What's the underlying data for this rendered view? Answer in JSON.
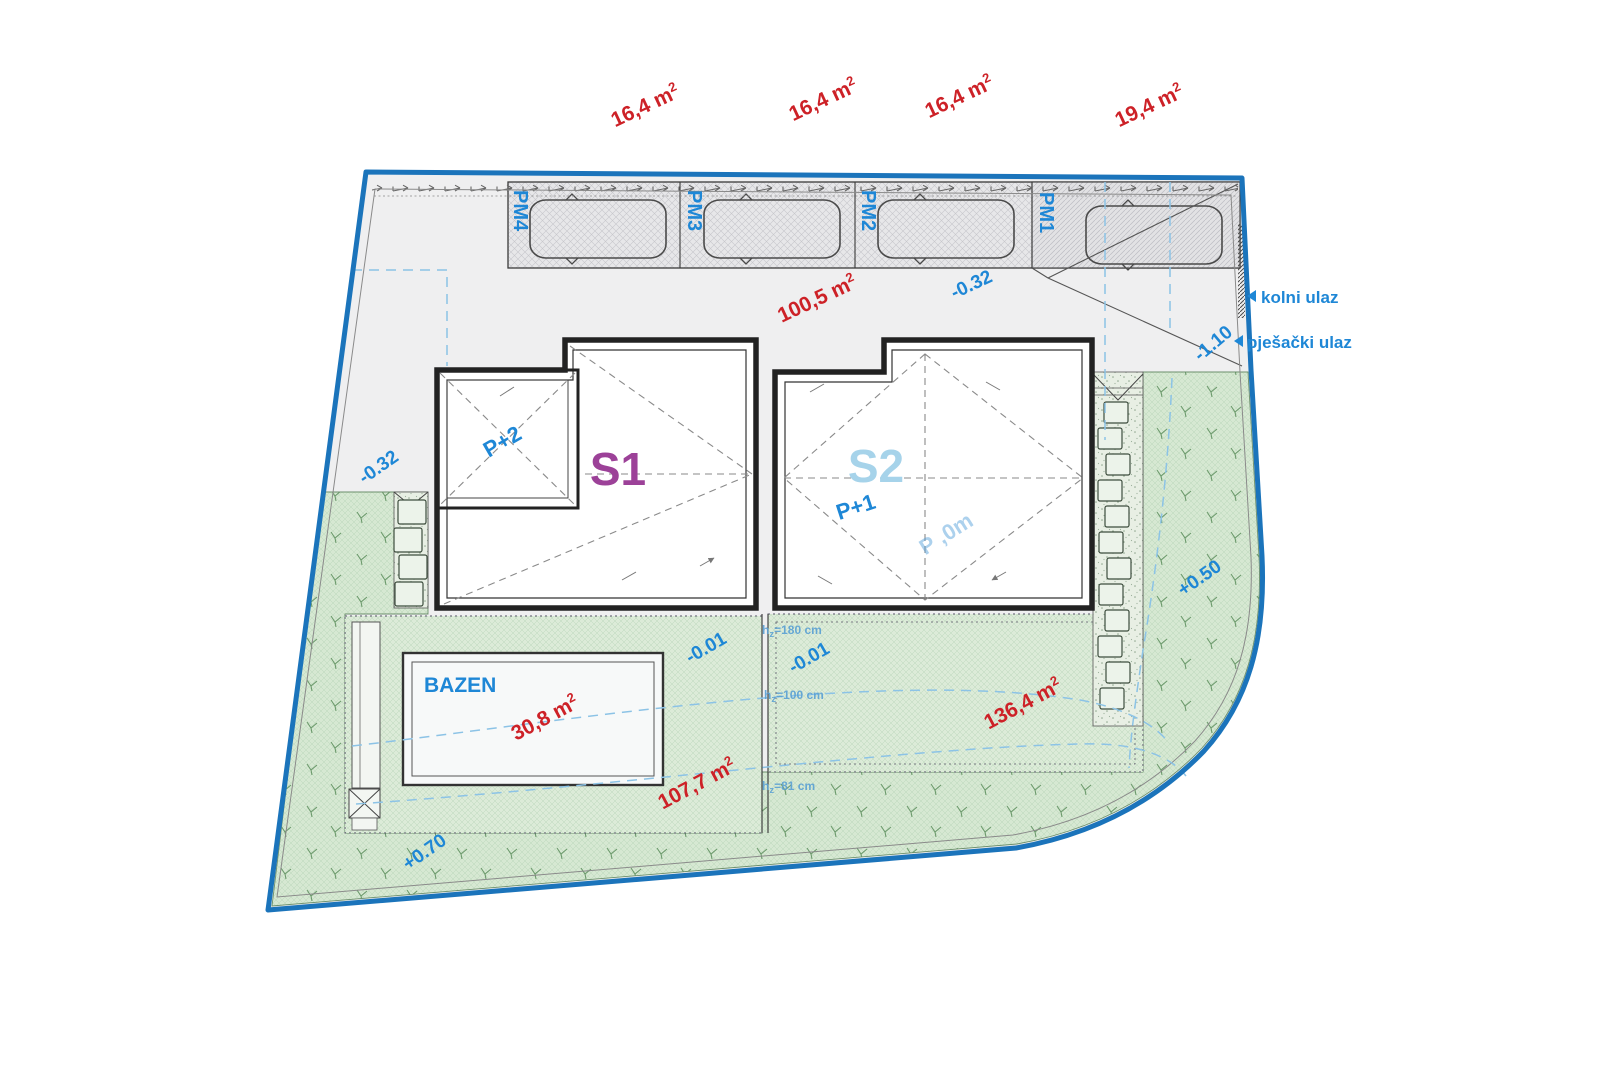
{
  "plan": {
    "parking": {
      "stalls": [
        {
          "id": "PM4",
          "area": "16,4 m",
          "sup": "2"
        },
        {
          "id": "PM3",
          "area": "16,4 m",
          "sup": "2"
        },
        {
          "id": "PM2",
          "area": "16,4 m",
          "sup": "2"
        },
        {
          "id": "PM1",
          "area": "19,4 m",
          "sup": "2"
        }
      ]
    },
    "paved_area": {
      "value": "100,5 m",
      "sup": "2"
    },
    "pool": {
      "label": "BAZEN",
      "value": "30,8 m",
      "sup": "2"
    },
    "terrace": {
      "value": "107,7 m",
      "sup": "2"
    },
    "garden": {
      "value": "136,4 m",
      "sup": "2"
    },
    "buildings": {
      "s1": {
        "id": "S1",
        "floors": "P+2"
      },
      "s2": {
        "id": "S2",
        "floors": "P+1",
        "note": "P ,0m"
      }
    },
    "levels": {
      "l032a": "-0.32",
      "l032b": "-0.32",
      "l110": "-1.10",
      "l001a": "-0.01",
      "l001b": "-0.01",
      "p050": "+0.50",
      "p070": "+0.70"
    },
    "heights": [
      {
        "base": "h",
        "sub": "z",
        "value": "=180 cm"
      },
      {
        "base": "h",
        "sub": "z",
        "value": "=100 cm"
      },
      {
        "base": "h",
        "sub": "z",
        "value": "=81 cm"
      }
    ],
    "entrances": {
      "vehicle": "kolni ulaz",
      "pedestrian": "pješački ulaz"
    },
    "colors": {
      "boundary_blue": "#1b74bb",
      "label_blue": "#1e87d6",
      "area_red": "#cd2127",
      "s1_purple": "#9c4198",
      "s2_lightblue": "#a6d3ea",
      "dashed_blue": "#8cc3e6",
      "height_blue": "#5aa0d4"
    }
  }
}
